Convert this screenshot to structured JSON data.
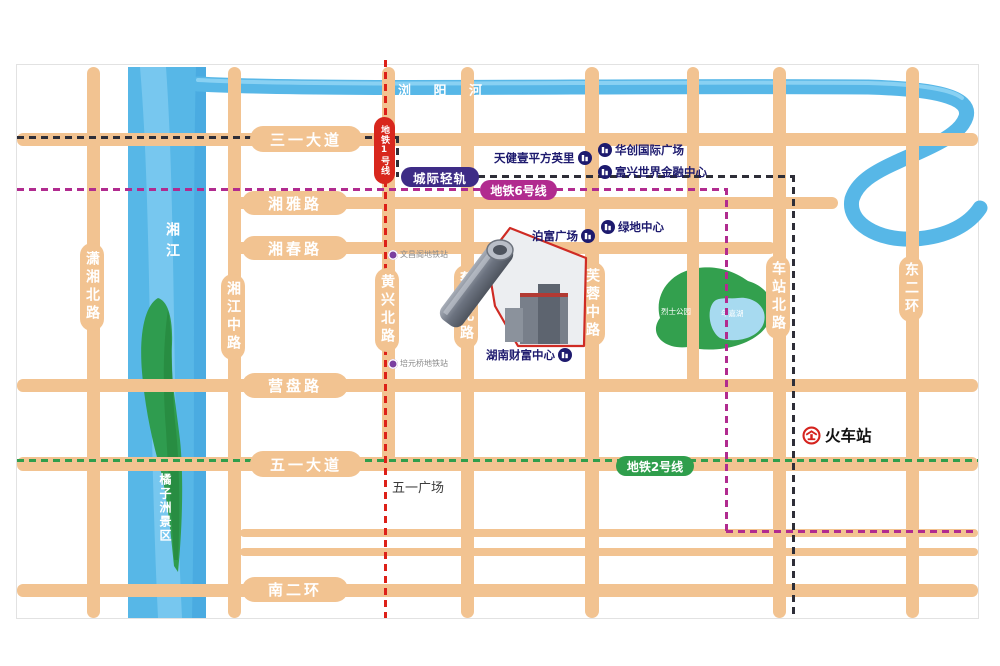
{
  "rivers": {
    "liuyang": "浏 阳 河",
    "xiang": "湘江",
    "island": "橘子洲景区"
  },
  "park": {
    "name": "烈士公园",
    "lake": "年嘉湖"
  },
  "roads": {
    "sanyi": "三一大道",
    "xiangya": "湘雅路",
    "xiangchun": "湘春路",
    "yingpan": "营盘路",
    "wuyi": "五一大道",
    "nanerhuan": "南二环",
    "xiaoxiang": "潇湘北路",
    "xiangjiang_mid": "湘江中路",
    "huangxing": "黄兴北路",
    "caie": "蔡锷北路",
    "furong": "芙蓉中路",
    "chezhan": "车站北路",
    "dongerhuan": "东二环"
  },
  "transit": {
    "line1": "地铁1号线",
    "line2": "地铁2号线",
    "line6": "地铁6号线",
    "intercity": "城际轻轨",
    "stations": {
      "wenchangge": "文昌阁地铁站",
      "peiyuanqiao": "培元桥地铁站"
    }
  },
  "pois": {
    "tianjian": "天健壹平方英里",
    "huachuang": "华创国际广场",
    "fuxing": "富兴世界金融中心",
    "lvdi": "绿地中心",
    "bofu": "泊富广场",
    "hncaifu": "湖南财富中心"
  },
  "landmarks": {
    "railway": "火车站",
    "wuyi_square": "五一广场"
  },
  "colors": {
    "road": "#f2c391",
    "river": "#57b7e7",
    "park_green": "#33a04e",
    "line1_red": "#dd2018",
    "line2_green": "#2f9e4c",
    "line6_magenta": "#b12b8f",
    "intercity_dark": "#2e2e38",
    "intercity_badge": "#3e2c86",
    "poi_navy": "#1d1a6e",
    "station_purple": "#7b3fa0",
    "railway_red": "#d5231e"
  }
}
